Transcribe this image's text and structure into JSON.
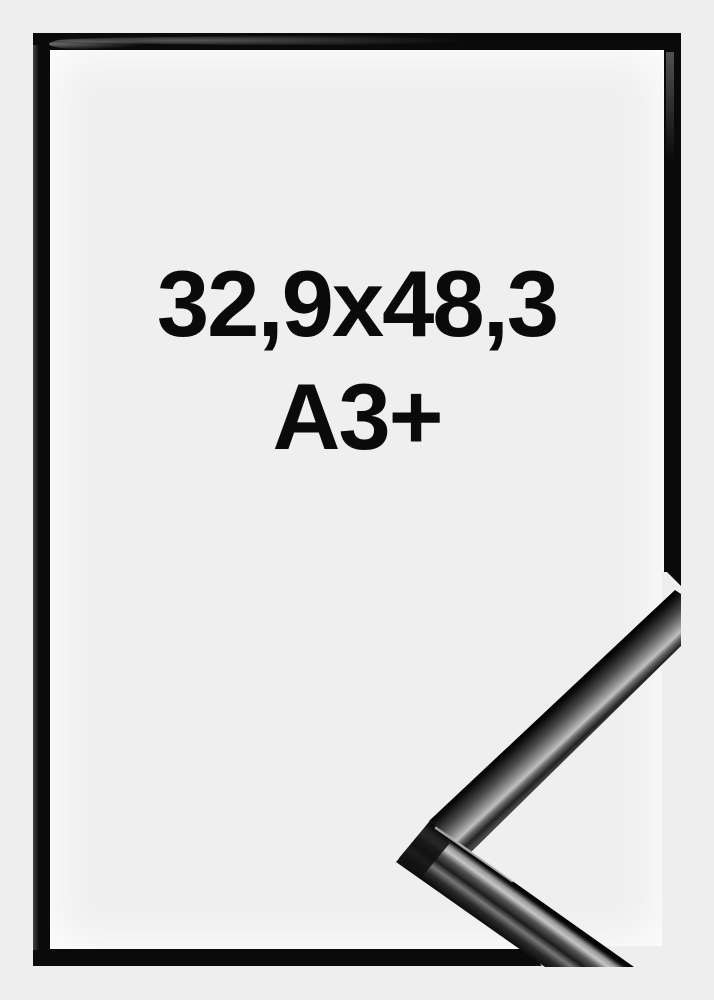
{
  "product": {
    "size_line1": "32,9x48,3",
    "size_line2": "A3+"
  },
  "colors": {
    "background": "#eeeeee",
    "frame": "#0a0a0a",
    "text": "#0a0a0a",
    "detail_highlight": "#c6c6c6"
  }
}
